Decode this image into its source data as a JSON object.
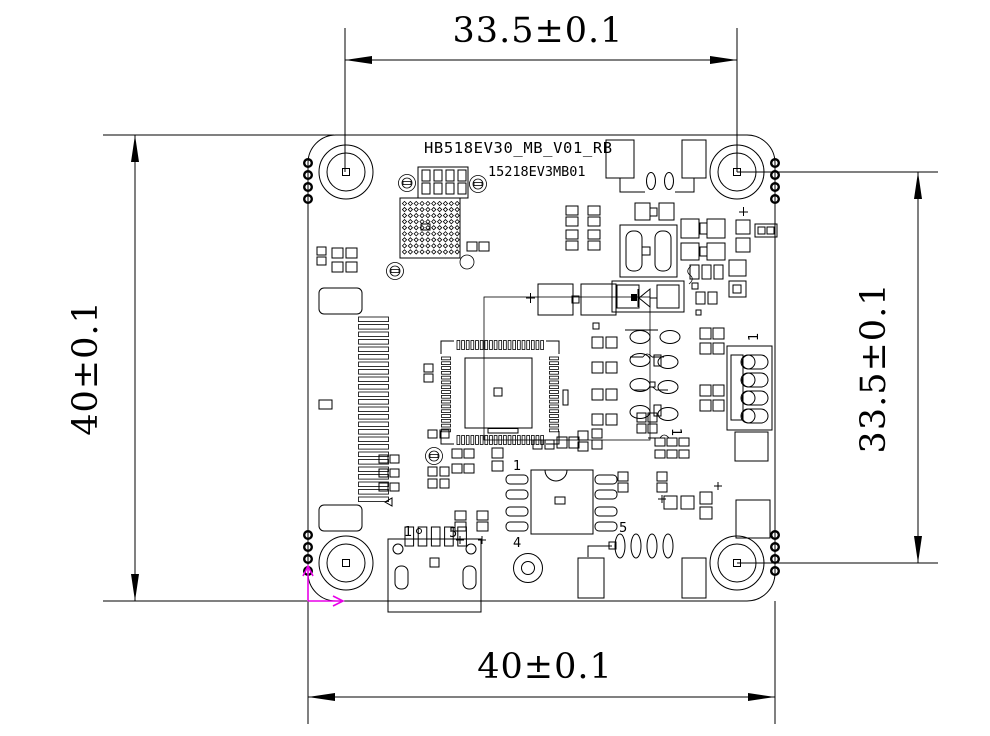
{
  "drawing": {
    "labels": {
      "board_name": "HB518EV30_MB_V01_RB",
      "board_code": "15218EV3MB01"
    },
    "dimensions": {
      "top": "33.5±0.1",
      "left": "40±0.1",
      "right": "33.5±0.1",
      "bottom": "40±0.1"
    },
    "pin_labels": {
      "usb_pin1": "1",
      "usb_pin5": "5",
      "ic_pin1": "1",
      "ic_pin4": "4",
      "ic_pin5": "5",
      "connector_pin1": "1",
      "component_pin1": "1"
    },
    "colors": {
      "line": "#000000",
      "origin_marker": "#e800e8",
      "background": "#ffffff"
    }
  }
}
